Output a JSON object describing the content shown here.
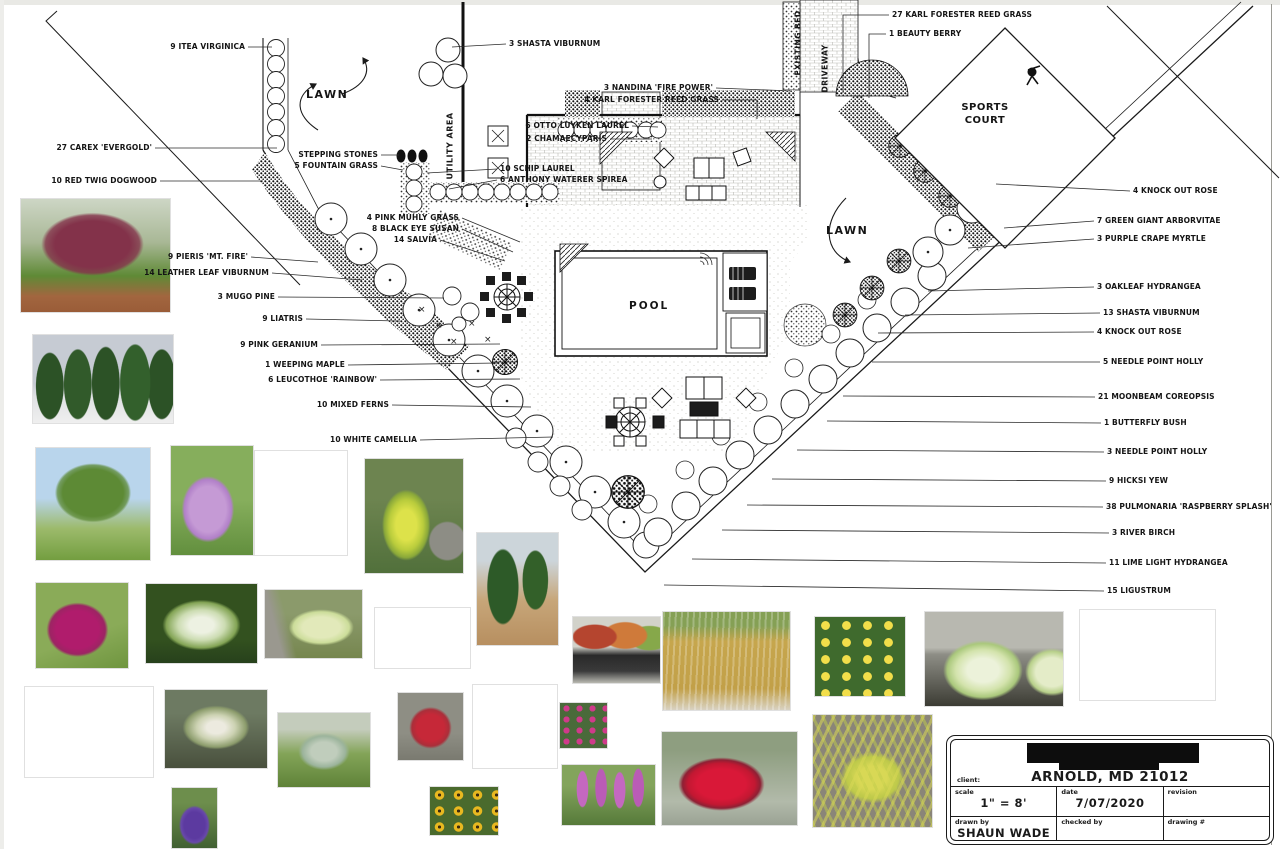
{
  "plan": {
    "area_labels": {
      "lawn_left": "LAWN",
      "lawn_right": "LAWN",
      "pool": "POOL",
      "sports_court": "SPORTS COURT",
      "utility_area": "UTILITY AREA",
      "existing_bed": "EXISTING BED",
      "driveway": "DRIVEWAY"
    },
    "callouts": [
      {
        "t": "9 ITEA VIRGINICA",
        "side": "L",
        "lx": 248,
        "ly": 47,
        "tx": 272,
        "ty": 47
      },
      {
        "t": "27 CAREX 'EVERGOLD'",
        "side": "L",
        "lx": 155,
        "ly": 148,
        "tx": 277,
        "ty": 148
      },
      {
        "t": "10 RED TWIG DOGWOOD",
        "side": "L",
        "lx": 160,
        "ly": 181,
        "tx": 263,
        "ty": 181
      },
      {
        "t": "STEPPING STONES",
        "side": "L",
        "lx": 381,
        "ly": 155,
        "tx": 399,
        "ty": 155
      },
      {
        "t": "5 FOUNTAIN GRASS",
        "side": "L",
        "lx": 381,
        "ly": 166,
        "tx": 403,
        "ty": 170
      },
      {
        "t": "3 SHASTA VIBURNUM",
        "side": "R",
        "lx": 506,
        "ly": 44,
        "tx": 452,
        "ty": 47
      },
      {
        "t": "3 NANDINA 'FIRE POWER'",
        "side": "L",
        "lx": 716,
        "ly": 88,
        "tx": 792,
        "ty": 91
      },
      {
        "t": "4 KARL FORESTER REED GRASS",
        "side": "L",
        "lx": 722,
        "ly": 100,
        "mx": 757,
        "my": 100,
        "tx": 757,
        "ty": 119
      },
      {
        "t": "6 OTTO LUYKEN LAUREL",
        "side": "L",
        "lx": 632,
        "ly": 126,
        "tx": 658,
        "ty": 127
      },
      {
        "t": "2 CHAMAECYPARIS",
        "side": "L",
        "lx": 610,
        "ly": 139,
        "tx": 652,
        "ty": 139
      },
      {
        "t": "10 SCHIP LAUREL",
        "side": "R",
        "lx": 497,
        "ly": 169,
        "tx": 427,
        "ty": 173
      },
      {
        "t": "6 ANTHONY WATERER SPIREA",
        "side": "R",
        "lx": 497,
        "ly": 180,
        "tx": 449,
        "ty": 189
      },
      {
        "t": "27 KARL FORESTER REED GRASS",
        "side": "R",
        "lx": 889,
        "ly": 15,
        "mx": 843,
        "my": 15,
        "tx": 843,
        "ty": 93
      },
      {
        "t": "1 BEAUTY BERRY",
        "side": "R",
        "lx": 886,
        "ly": 34,
        "mx": 869,
        "my": 34,
        "tx": 869,
        "ty": 98
      },
      {
        "t": "4 PINK MUHLY GRASS",
        "side": "L",
        "lx": 462,
        "ly": 218,
        "tx": 520,
        "ty": 242
      },
      {
        "t": "8 BLACK EYE SUSAN",
        "side": "L",
        "lx": 462,
        "ly": 229,
        "tx": 513,
        "ty": 252
      },
      {
        "t": "14 SALVIA",
        "side": "L",
        "lx": 440,
        "ly": 240,
        "tx": 505,
        "ty": 261
      },
      {
        "t": "9 PIERIS 'MT. FIRE'",
        "side": "L",
        "lx": 251,
        "ly": 257,
        "tx": 318,
        "ty": 262
      },
      {
        "t": "14 LEATHER LEAF VIBURNUM",
        "side": "L",
        "lx": 272,
        "ly": 273,
        "tx": 362,
        "ty": 280
      },
      {
        "t": "3 MUGO PINE",
        "side": "L",
        "lx": 278,
        "ly": 297,
        "tx": 444,
        "ty": 298
      },
      {
        "t": "9 LIATRIS",
        "side": "L",
        "lx": 306,
        "ly": 319,
        "tx": 400,
        "ty": 321
      },
      {
        "t": "9 PINK GERANIUM",
        "side": "L",
        "lx": 321,
        "ly": 345,
        "tx": 500,
        "ty": 344
      },
      {
        "t": "1 WEEPING MAPLE",
        "side": "L",
        "lx": 348,
        "ly": 365,
        "tx": 499,
        "ty": 363
      },
      {
        "t": "6 LEUCOTHOE 'RAINBOW'",
        "side": "L",
        "lx": 380,
        "ly": 380,
        "tx": 520,
        "ty": 379
      },
      {
        "t": "10 MIXED FERNS",
        "side": "L",
        "lx": 392,
        "ly": 405,
        "tx": 531,
        "ty": 407
      },
      {
        "t": "10 WHITE CAMELLIA",
        "side": "L",
        "lx": 420,
        "ly": 440,
        "tx": 553,
        "ty": 437
      },
      {
        "t": "4 KNOCK OUT ROSE",
        "side": "R",
        "lx": 1130,
        "ly": 191,
        "tx": 996,
        "ty": 184
      },
      {
        "t": "7 GREEN GIANT ARBORVITAE",
        "side": "R",
        "lx": 1094,
        "ly": 221,
        "tx": 1004,
        "ty": 228
      },
      {
        "t": "3 PURPLE CRAPE MYRTLE",
        "side": "R",
        "lx": 1094,
        "ly": 239,
        "tx": 968,
        "ty": 248
      },
      {
        "t": "3 OAKLEAF HYDRANGEA",
        "side": "R",
        "lx": 1094,
        "ly": 287,
        "tx": 928,
        "ty": 291
      },
      {
        "t": "13 SHASTA VIBURNUM",
        "side": "R",
        "lx": 1100,
        "ly": 313,
        "tx": 905,
        "ty": 315
      },
      {
        "t": "4 KNOCK OUT ROSE",
        "side": "R",
        "lx": 1094,
        "ly": 332,
        "tx": 878,
        "ty": 333
      },
      {
        "t": "5 NEEDLE POINT HOLLY",
        "side": "R",
        "lx": 1100,
        "ly": 362,
        "tx": 872,
        "ty": 362
      },
      {
        "t": "21 MOONBEAM COREOPSIS",
        "side": "R",
        "lx": 1095,
        "ly": 397,
        "tx": 843,
        "ty": 396
      },
      {
        "t": "1 BUTTERFLY BUSH",
        "side": "R",
        "lx": 1101,
        "ly": 423,
        "tx": 827,
        "ty": 421
      },
      {
        "t": "3 NEEDLE POINT HOLLY",
        "side": "R",
        "lx": 1104,
        "ly": 452,
        "tx": 797,
        "ty": 450
      },
      {
        "t": "9 HICKSI YEW",
        "side": "R",
        "lx": 1106,
        "ly": 481,
        "tx": 772,
        "ty": 479
      },
      {
        "t": "38 PULMONARIA 'RASPBERRY SPLASH'",
        "side": "R",
        "lx": 1103,
        "ly": 507,
        "tx": 747,
        "ty": 505
      },
      {
        "t": "3 RIVER BIRCH",
        "side": "R",
        "lx": 1109,
        "ly": 533,
        "tx": 722,
        "ty": 530
      },
      {
        "t": "11 LIME LIGHT HYDRANGEA",
        "side": "R",
        "lx": 1106,
        "ly": 563,
        "tx": 692,
        "ty": 559
      },
      {
        "t": "15 LIGUSTRUM",
        "side": "R",
        "lx": 1104,
        "ly": 591,
        "tx": 664,
        "ty": 585
      }
    ]
  },
  "photos": [
    {
      "name": "weeping-japanese-maple",
      "x": 21,
      "y": 199,
      "w": 149,
      "h": 113
    },
    {
      "name": "green-giant-arborvitae",
      "x": 33,
      "y": 335,
      "w": 140,
      "h": 88
    },
    {
      "name": "river-birch",
      "x": 36,
      "y": 448,
      "w": 114,
      "h": 112
    },
    {
      "name": "purple-crape-myrtle-bloom",
      "x": 171,
      "y": 446,
      "w": 82,
      "h": 109
    },
    {
      "name": "crape-myrtle-tree",
      "x": 255,
      "y": 451,
      "w": 92,
      "h": 104
    },
    {
      "name": "golden-chamaecyparis",
      "x": 365,
      "y": 459,
      "w": 98,
      "h": 114
    },
    {
      "name": "butterfly-bush",
      "x": 36,
      "y": 583,
      "w": 92,
      "h": 85
    },
    {
      "name": "white-plume-shrub",
      "x": 146,
      "y": 584,
      "w": 111,
      "h": 79
    },
    {
      "name": "limelight-hydrangea-hedge",
      "x": 265,
      "y": 590,
      "w": 97,
      "h": 68
    },
    {
      "name": "pink-geranium",
      "x": 375,
      "y": 608,
      "w": 95,
      "h": 60
    },
    {
      "name": "hicksii-yew",
      "x": 477,
      "y": 533,
      "w": 81,
      "h": 112
    },
    {
      "name": "nandina-pots",
      "x": 573,
      "y": 617,
      "w": 87,
      "h": 66
    },
    {
      "name": "karl-foerster-reed-grass",
      "x": 663,
      "y": 612,
      "w": 127,
      "h": 98
    },
    {
      "name": "moonbeam-coreopsis",
      "x": 815,
      "y": 617,
      "w": 90,
      "h": 79
    },
    {
      "name": "variegated-ligustrum",
      "x": 925,
      "y": 612,
      "w": 138,
      "h": 94
    },
    {
      "name": "leucothoe-rainbow",
      "x": 1080,
      "y": 610,
      "w": 135,
      "h": 90
    },
    {
      "name": "beautyberry",
      "x": 25,
      "y": 687,
      "w": 128,
      "h": 90
    },
    {
      "name": "pieris-blooms",
      "x": 165,
      "y": 690,
      "w": 102,
      "h": 78
    },
    {
      "name": "blue-green-shrub",
      "x": 278,
      "y": 713,
      "w": 92,
      "h": 74
    },
    {
      "name": "red-spirea",
      "x": 398,
      "y": 693,
      "w": 65,
      "h": 67
    },
    {
      "name": "garden-phlox",
      "x": 473,
      "y": 685,
      "w": 84,
      "h": 83
    },
    {
      "name": "pink-dianthus",
      "x": 560,
      "y": 703,
      "w": 47,
      "h": 45
    },
    {
      "name": "purple-salvia",
      "x": 172,
      "y": 788,
      "w": 45,
      "h": 60
    },
    {
      "name": "black-eyed-susan",
      "x": 430,
      "y": 787,
      "w": 68,
      "h": 48
    },
    {
      "name": "pink-liatris",
      "x": 562,
      "y": 765,
      "w": 93,
      "h": 60
    },
    {
      "name": "knock-out-roses",
      "x": 662,
      "y": 732,
      "w": 135,
      "h": 93
    },
    {
      "name": "carex-evergold",
      "x": 813,
      "y": 715,
      "w": 119,
      "h": 112
    }
  ],
  "title_block": {
    "client_label": "client:",
    "client_value": "ARNOLD, MD 21012",
    "scale_label": "scale",
    "scale_value": "1\" = 8'",
    "date_label": "date",
    "date_value": "7/07/2020",
    "revision_label": "revision",
    "revision_value": "",
    "drawn_by_label": "drawn by",
    "drawn_by_value": "SHAUN WADE",
    "checked_by_label": "checked by",
    "checked_by_value": "",
    "drawing_no_label": "drawing #",
    "drawing_no_value": ""
  }
}
